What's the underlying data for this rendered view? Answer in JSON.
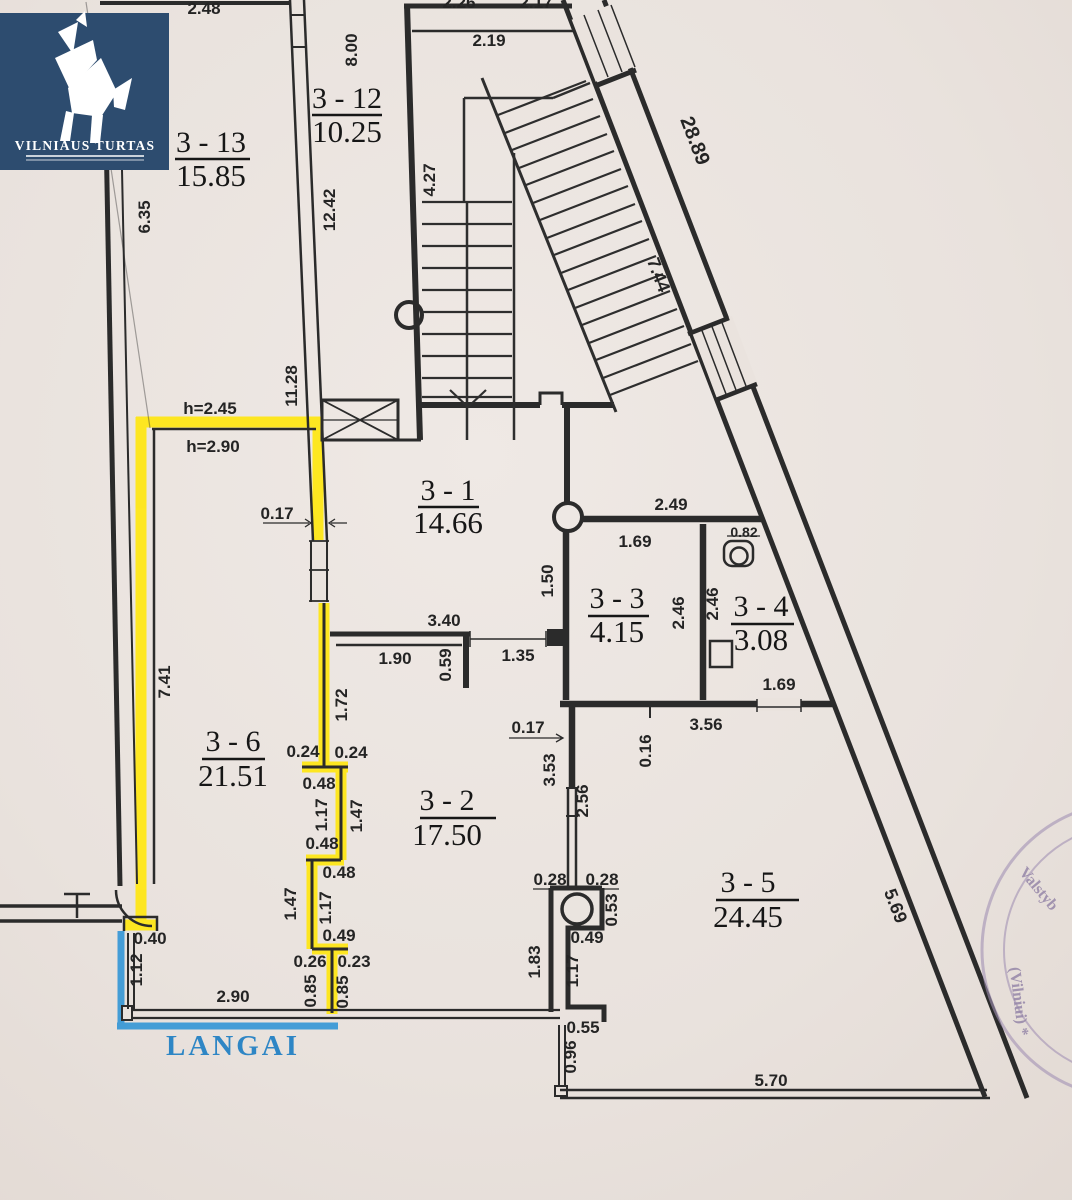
{
  "logo": {
    "title": "VILNIAUS TURTAS"
  },
  "window_marker": {
    "label": "LANGAI",
    "line_color": "#3b99d6"
  },
  "highlight": {
    "color": "#ffe713"
  },
  "stamp": {
    "fragments": [
      "Valstyb",
      "(Vilniui) *"
    ]
  },
  "plan": {
    "rooms": [
      {
        "id": "3 - 13",
        "area": "15.85",
        "cx": 211,
        "ny": 152,
        "uy": 159,
        "ux1": 175,
        "ux2": 250,
        "ay": 186
      },
      {
        "id": "3 - 12",
        "area": "10.25",
        "cx": 347,
        "ny": 108,
        "uy": 115,
        "ux1": 312,
        "ux2": 382,
        "ay": 142
      },
      {
        "id": "3 - 1",
        "area": "14.66",
        "cx": 448,
        "ny": 500,
        "uy": 507,
        "ux1": 418,
        "ux2": 479,
        "ay": 533
      },
      {
        "id": "3 - 3",
        "area": "4.15",
        "cx": 617,
        "ny": 608,
        "uy": 616,
        "ux1": 588,
        "ux2": 649,
        "ay": 642
      },
      {
        "id": "3 - 4",
        "area": "3.08",
        "cx": 761,
        "ny": 616,
        "uy": 624,
        "ux1": 731,
        "ux2": 794,
        "ay": 650
      },
      {
        "id": "3 - 6",
        "area": "21.51",
        "cx": 233,
        "ny": 751,
        "uy": 759,
        "ux1": 202,
        "ux2": 265,
        "ay": 786
      },
      {
        "id": "3 - 2",
        "area": "17.50",
        "cx": 447,
        "ny": 810,
        "uy": 818,
        "ux1": 420,
        "ux2": 496,
        "ay": 845
      },
      {
        "id": "3 - 5",
        "area": "24.45",
        "cx": 748,
        "ny": 892,
        "uy": 900,
        "ux1": 716,
        "ux2": 799,
        "ay": 927
      }
    ],
    "dims": [
      {
        "t": "2.48",
        "x": 204,
        "y": 14
      },
      {
        "t": "2.26",
        "x": 459,
        "y": 8
      },
      {
        "t": "2.17",
        "x": 536,
        "y": 8
      },
      {
        "t": "2.19",
        "x": 489,
        "y": 46
      },
      {
        "t": "8.00",
        "x": 357,
        "y": 50,
        "r": -90
      },
      {
        "t": "12.42",
        "x": 335,
        "y": 210,
        "r": -90
      },
      {
        "t": "6.35",
        "x": 150,
        "y": 217,
        "r": -90
      },
      {
        "t": "4.27",
        "x": 435,
        "y": 180,
        "r": -90
      },
      {
        "t": "11.28",
        "x": 297,
        "y": 386,
        "r": -90
      },
      {
        "t": "28.89",
        "x": 689,
        "y": 143,
        "r": 69,
        "s": 20
      },
      {
        "t": "7.44",
        "x": 653,
        "y": 277,
        "r": 69,
        "s": 18
      },
      {
        "t": "h=2.45",
        "x": 210,
        "y": 414
      },
      {
        "t": "h=2.90",
        "x": 213,
        "y": 452
      },
      {
        "t": "0.17",
        "x": 277,
        "y": 519
      },
      {
        "t": "2.49",
        "x": 671,
        "y": 510
      },
      {
        "t": "1.69",
        "x": 635,
        "y": 547
      },
      {
        "t": "0.82",
        "x": 744,
        "y": 537,
        "s": 14
      },
      {
        "t": "1.50",
        "x": 553,
        "y": 581,
        "r": -90
      },
      {
        "t": "2.46",
        "x": 684,
        "y": 613,
        "r": -90
      },
      {
        "t": "2.46",
        "x": 718,
        "y": 604,
        "r": -90
      },
      {
        "t": "3.40",
        "x": 444,
        "y": 626
      },
      {
        "t": "1.90",
        "x": 395,
        "y": 664
      },
      {
        "t": "0.59",
        "x": 451,
        "y": 665,
        "r": -90
      },
      {
        "t": "1.35",
        "x": 518,
        "y": 661
      },
      {
        "t": "1.72",
        "x": 347,
        "y": 705,
        "r": -90
      },
      {
        "t": "7.41",
        "x": 170,
        "y": 682,
        "r": -90
      },
      {
        "t": "0.17",
        "x": 528,
        "y": 733
      },
      {
        "t": "3.56",
        "x": 706,
        "y": 730
      },
      {
        "t": "0.16",
        "x": 651,
        "y": 751,
        "r": -90
      },
      {
        "t": "1.69",
        "x": 779,
        "y": 690
      },
      {
        "t": "0.24",
        "x": 303,
        "y": 757
      },
      {
        "t": "0.24",
        "x": 351,
        "y": 758
      },
      {
        "t": "0.48",
        "x": 319,
        "y": 789
      },
      {
        "t": "1.17",
        "x": 327,
        "y": 815,
        "r": -90
      },
      {
        "t": "1.47",
        "x": 362,
        "y": 816,
        "r": -90
      },
      {
        "t": "0.48",
        "x": 322,
        "y": 849
      },
      {
        "t": "3.53",
        "x": 555,
        "y": 770,
        "r": -90
      },
      {
        "t": "2.56",
        "x": 588,
        "y": 801,
        "r": -90
      },
      {
        "t": "0.48",
        "x": 339,
        "y": 878
      },
      {
        "t": "1.47",
        "x": 296,
        "y": 904,
        "r": -90
      },
      {
        "t": "1.17",
        "x": 331,
        "y": 908,
        "r": -90
      },
      {
        "t": "0.49",
        "x": 339,
        "y": 941
      },
      {
        "t": "0.26",
        "x": 310,
        "y": 967
      },
      {
        "t": "0.23",
        "x": 354,
        "y": 967
      },
      {
        "t": "0.85",
        "x": 316,
        "y": 991,
        "r": -90
      },
      {
        "t": "0.85",
        "x": 348,
        "y": 992,
        "r": -90
      },
      {
        "t": "0.28",
        "x": 550,
        "y": 885
      },
      {
        "t": "0.28",
        "x": 602,
        "y": 885
      },
      {
        "t": "0.53",
        "x": 617,
        "y": 910,
        "r": -90
      },
      {
        "t": "0.49",
        "x": 587,
        "y": 943
      },
      {
        "t": "1.83",
        "x": 540,
        "y": 962,
        "r": -90
      },
      {
        "t": "1.17",
        "x": 578,
        "y": 971,
        "r": -90
      },
      {
        "t": "0.40",
        "x": 150,
        "y": 944
      },
      {
        "t": "1.12",
        "x": 142,
        "y": 970,
        "r": -90
      },
      {
        "t": "2.90",
        "x": 233,
        "y": 1002
      },
      {
        "t": "0.55",
        "x": 583,
        "y": 1033
      },
      {
        "t": "0.96",
        "x": 576,
        "y": 1057,
        "r": -90
      },
      {
        "t": "5.70",
        "x": 771,
        "y": 1086
      },
      {
        "t": "5.69",
        "x": 890,
        "y": 908,
        "r": 69,
        "s": 18
      }
    ]
  }
}
